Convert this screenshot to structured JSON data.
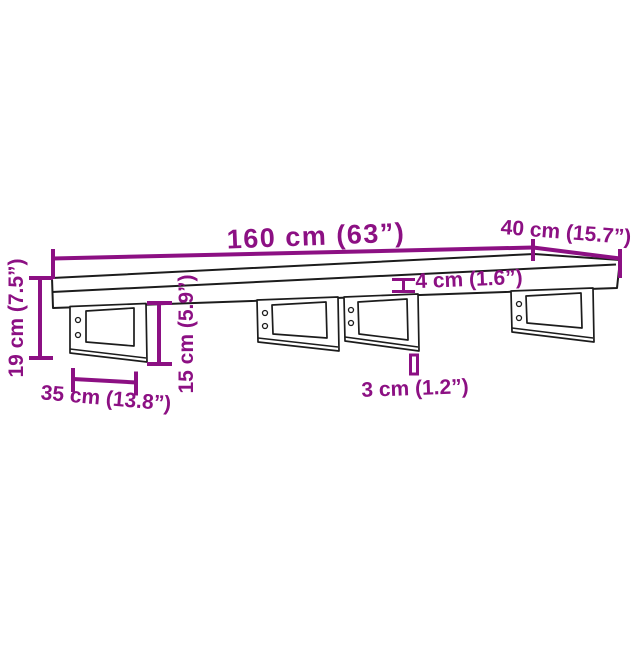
{
  "colors": {
    "background": "#ffffff",
    "outline": "#1c1c1c",
    "dimension": "#8C1083"
  },
  "dimensions": {
    "length": "160 cm (63”)",
    "depth": "40 cm (15.7”)",
    "board_thickness": "4 cm (1.6”)",
    "total_height": "19 cm (7.5”)",
    "bracket_height": "15 cm (5.9”)",
    "bracket_depth": "35 cm (13.8”)",
    "bracket_thickness": "3 cm (1.2”)"
  }
}
